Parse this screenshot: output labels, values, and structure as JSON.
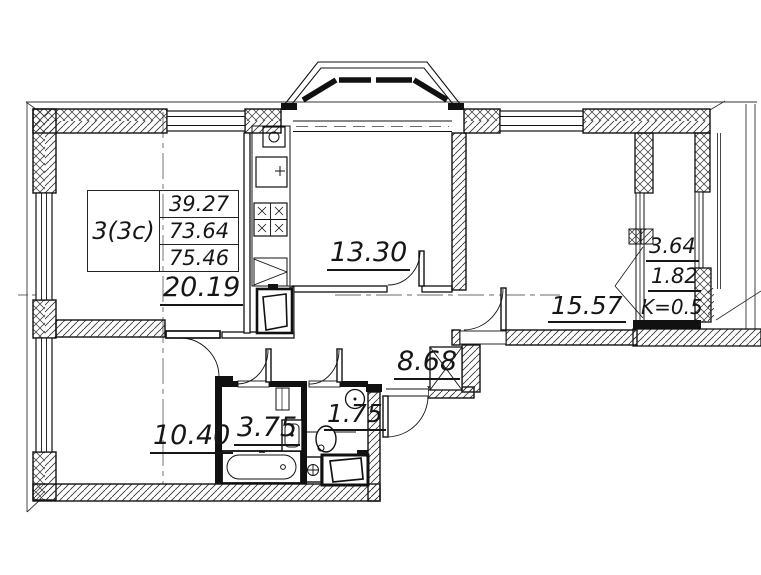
{
  "drawing": {
    "unit_box": {
      "type": "3(3c)",
      "values": [
        "39.27",
        "73.64",
        "75.46"
      ]
    },
    "room_areas": {
      "living_room": "20.19",
      "kitchen": "13.30",
      "bedroom_right": "15.57",
      "hallway": "8.68",
      "bedroom_left": "10.40",
      "bathroom": "3.75",
      "wc": "1.75"
    },
    "loggia": {
      "area": "3.64",
      "counted_area": "1.82",
      "coefficient": "K=0.5"
    },
    "colors": {
      "ink": "#161616",
      "paper": "#ffffff"
    }
  }
}
